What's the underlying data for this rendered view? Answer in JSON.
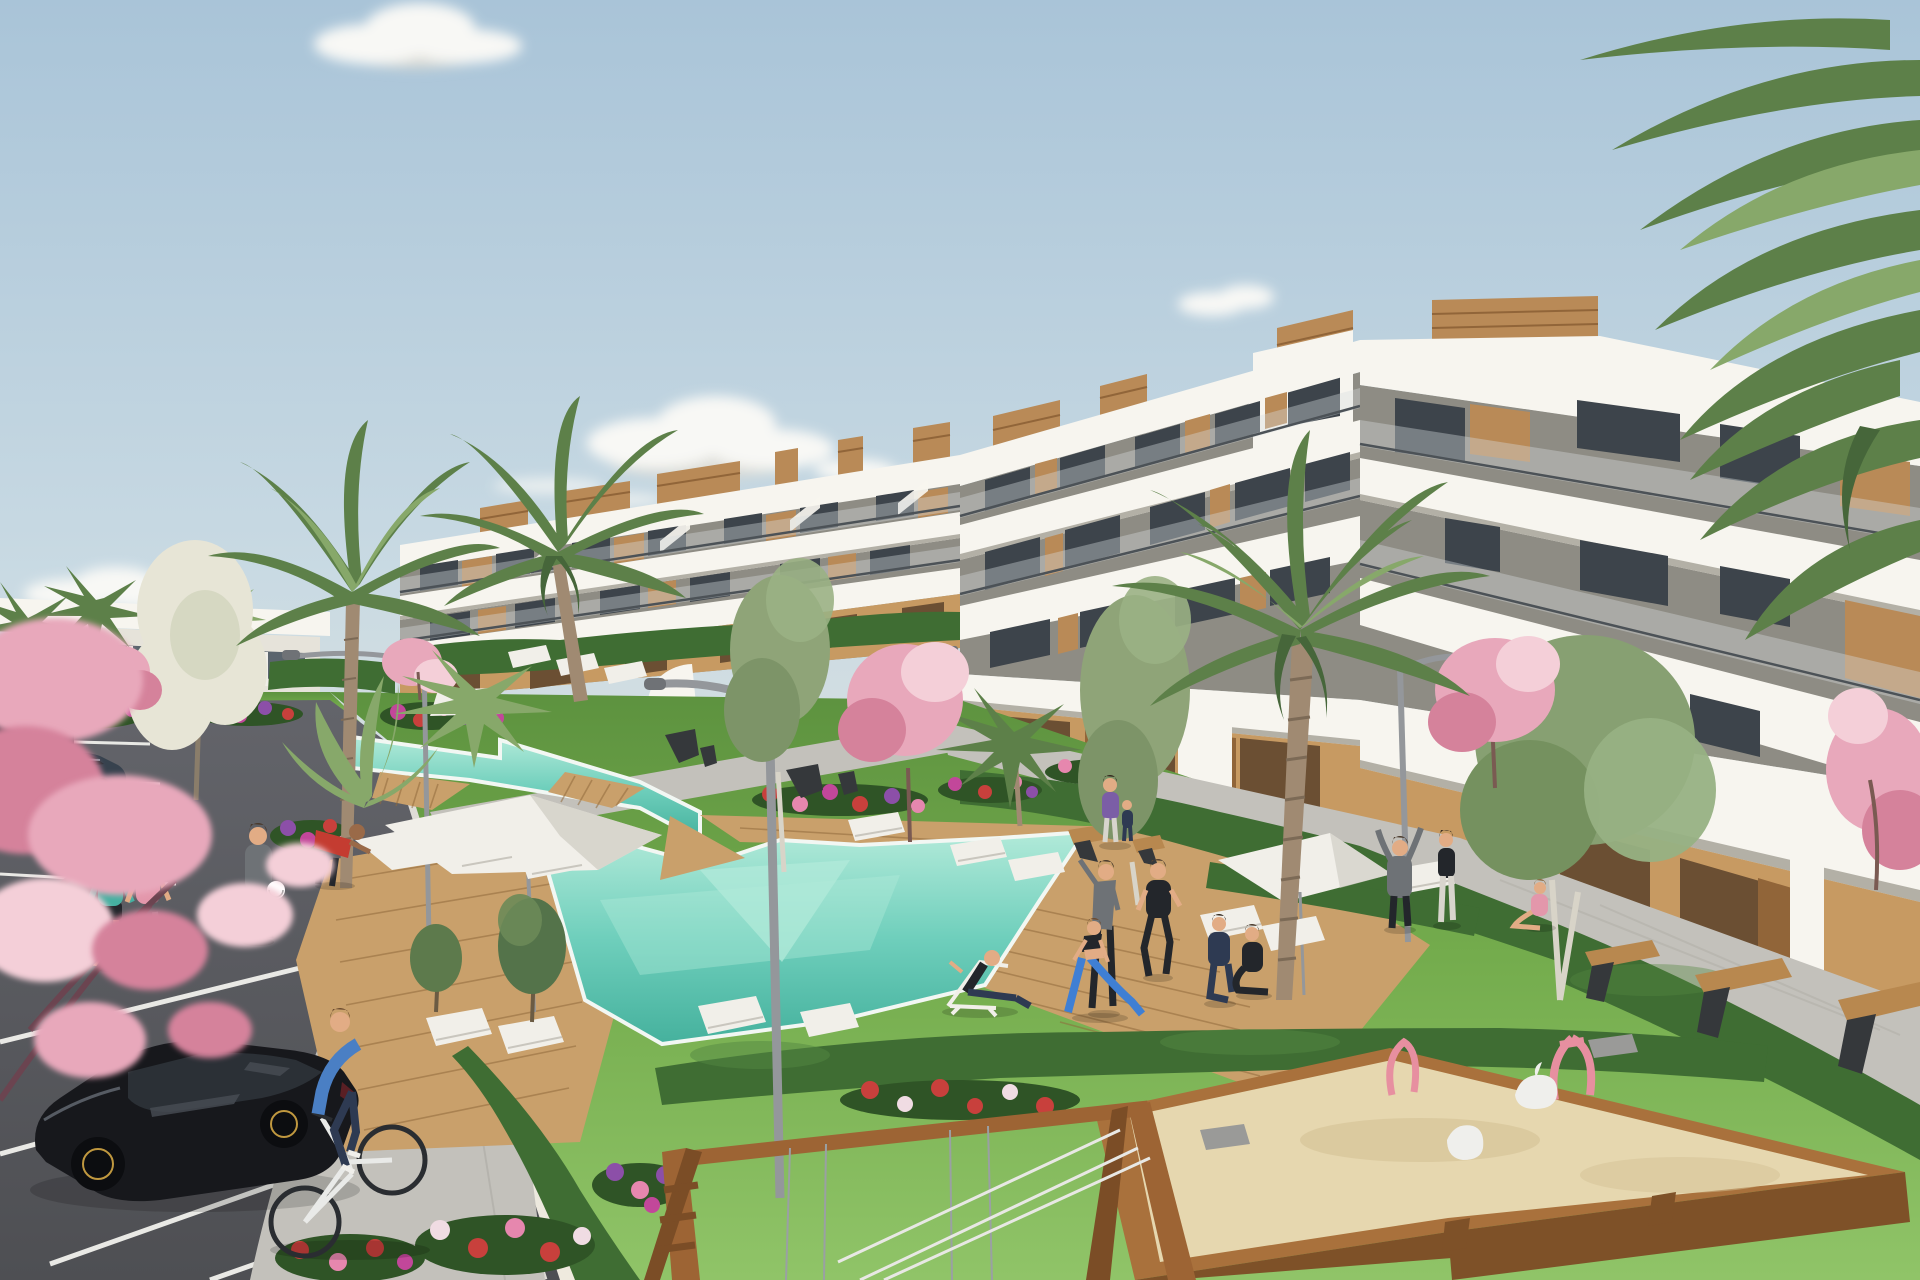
{
  "scene": {
    "type": "architectural-render",
    "description": "Sunny 3D visualisation of a modern white terraced apartment complex with communal gardens, turquoise pools, palm trees, parking lot, playground sandbox and residents relaxing outdoors",
    "time_of_day": "daytime",
    "sky": {
      "clouds": 5,
      "tone": "pale blue with warm haze at horizon"
    }
  },
  "palette": {
    "sky_top": "#a9c4d8",
    "sky_mid": "#c9dae3",
    "sky_low": "#e7e6dd",
    "sky_haze": "#efeade",
    "cloud": "#f8f8f5",
    "cloud_shade": "#dcdcd6",
    "white_sun": "#f7f5ef",
    "white_shade": "#e6e3da",
    "white_dark": "#cbc8bf",
    "fascia_under": "#b3b0a6",
    "recess": "#8e8c84",
    "glass_dark": "#3d444b",
    "glass_mid": "#5a646d",
    "glass_rail": "rgba(215,222,224,0.38)",
    "rail": "#4c5257",
    "wood": "#b98a57",
    "wood_dark": "#916539",
    "wood_light": "#d0a976",
    "tan_wall": "#c79a62",
    "tan_dark": "#a87c49",
    "opening": "#6b4f33",
    "opening_dark": "#46331f",
    "grass_light": "#90c468",
    "grass": "#74ac4d",
    "grass_dark": "#5d923f",
    "hedge": "#3f6d33",
    "hedge_light": "#548741",
    "hedge_dark": "#2f5426",
    "flower_red": "#c8403c",
    "flower_magenta": "#c2479a",
    "flower_purple": "#8c4fa8",
    "flower_pink": "#e687ae",
    "flower_white": "#f0dce3",
    "pool_light": "#b2ead9",
    "pool": "#6fcfbc",
    "pool_deep": "#45b19d",
    "pool_rim": "#f2f7f3",
    "deck": "#c9a06b",
    "deck_dark": "#ab7f49",
    "deck_line": "#8f6a3c",
    "path": "#c3c1bb",
    "path_dark": "#a9a7a1",
    "curb": "#dedcd6",
    "asphalt": "#4e4f53",
    "asphalt_light": "#63646a",
    "line_white": "#e9e9e5",
    "lamp": "#94979b",
    "lamp_dark": "#6f7276",
    "car_black": "#17181c",
    "car_glass": "#2b3036",
    "car_highlight": "#484d55",
    "rim_gold": "#c0983f",
    "sedan": "#37424e",
    "suv": "#2b3137",
    "bench_wood": "#b8884f",
    "bench_dark": "#35383b",
    "sand": "#e6d7af",
    "sand_dark": "#d3c195",
    "box_wood": "#a9713c",
    "box_wood_dark": "#7e5128",
    "toy_pink": "#e78fa0",
    "toy_gray": "#9a9a98",
    "toy_white": "#efefec",
    "swing_wood": "#9d6434",
    "swing_dark": "#7b4d26",
    "cable": "#9aa0a3",
    "rope_white": "#e8e8e4",
    "skin": "#e2ac85",
    "skin_dark": "#9a6a48",
    "palm_green": "#5d8049",
    "palm_light": "#87a86a",
    "palm_dark": "#46663a",
    "palm_trunk": "#a08a72",
    "blossom_pink": "#e8a8bb",
    "blossom_deep": "#d5829b",
    "blossom_light": "#f4cfd8",
    "white_tree": "#e7e5d6",
    "lounger_white": "#f1efe9",
    "cloth_teal": "#45b0a1",
    "cloth_pink": "#e397ab",
    "cloth_blue": "#4a7fc4",
    "cloth_navy": "#2e3a52",
    "cloth_gray": "#6e7276",
    "cloth_red": "#c43c31",
    "cloth_purple": "#7b5ea6",
    "cloth_black": "#23262b",
    "legging_blue": "#3f7fd4",
    "bike_white": "#e9eae8"
  },
  "architecture": {
    "main_building": {
      "style": "stepped white terraced apartment block",
      "floors_visible": 4,
      "features": [
        "white balcony parapet bands",
        "glass balustrades",
        "dark glazing",
        "timber slat accent panels",
        "timber penthouse roof boxes",
        "roof terrace stairs",
        "arched ground-floor piers",
        "ochre ground-floor walls"
      ]
    },
    "distant_building": {
      "style": "low white block with dark glazing",
      "position": "far left"
    }
  },
  "amenities": {
    "pools": [
      {
        "name": "lap pool",
        "shape": "narrow angled channel",
        "position": "upper left"
      },
      {
        "name": "main pool",
        "shape": "angular freeform with shallow wedge",
        "position": "centre"
      }
    ],
    "wooden_decks": 3,
    "white_parasols": 3,
    "white_pergola": 1,
    "sun_loungers_white": 13,
    "designer_chairs_dark": 5,
    "benches_wood": 5,
    "street_lamps": 4
  },
  "vegetation": {
    "palm_trees_large": 3,
    "palm_trees_small": 6,
    "pink_blossom_trees": 6,
    "white_blossom_tree": 1,
    "green_trees": 5,
    "hedges": "clipped dark-green rows along paths and building base",
    "flower_beds": "magenta, red, purple and pink perennials"
  },
  "vehicles": [
    {
      "type": "black hatchback",
      "state": "parked",
      "position": "foreground parking"
    },
    {
      "type": "dark sedan",
      "state": "parked",
      "position": "mid parking"
    },
    {
      "type": "dark SUV",
      "state": "parked",
      "position": "far parking"
    }
  ],
  "people": [
    {
      "role": "cyclist",
      "clothing": "blue sweater, navy trousers",
      "position": "parking lane"
    },
    {
      "role": "jogger",
      "clothing": "teal top",
      "position": "sidewalk"
    },
    {
      "role": "jogger",
      "clothing": "pink top",
      "position": "sidewalk"
    },
    {
      "role": "man with football",
      "clothing": "gray tee",
      "position": "lawn"
    },
    {
      "role": "man tending flowers",
      "clothing": "red shirt",
      "position": "flower bed"
    },
    {
      "role": "man on deck chair",
      "clothing": "dark outfit",
      "position": "poolside lawn"
    },
    {
      "role": "stretching man",
      "clothing": "gray top",
      "position": "exercise lawn"
    },
    {
      "role": "runner",
      "clothing": "black sportswear",
      "position": "exercise lawn"
    },
    {
      "role": "lunging woman",
      "clothing": "black bra, blue leggings",
      "position": "exercise lawn"
    },
    {
      "role": "kneeling man",
      "clothing": "navy tracksuit",
      "position": "exercise lawn"
    },
    {
      "role": "seated woman",
      "clothing": "dark tracksuit",
      "position": "exercise lawn"
    },
    {
      "role": "woman with child",
      "clothing": "purple top",
      "position": "promenade"
    },
    {
      "role": "man arms raised",
      "clothing": "gray hoodie",
      "position": "right path"
    },
    {
      "role": "standing woman",
      "clothing": "black top, white trousers",
      "position": "right path"
    },
    {
      "role": "sitting girl",
      "clothing": "pink top",
      "position": "right path"
    }
  ],
  "playground": {
    "sandbox": {
      "frame": "timber beams",
      "toys": [
        "pink spring rider",
        "pink flamingo rocker",
        "white swan rocker",
        "white rocker",
        "gray digger toy"
      ]
    },
    "swing_frame": "timber A-frame with ladder and cables",
    "rope_fence": "white cords on low posts"
  },
  "parking": {
    "stall_lines": "white painted",
    "surface": "dark asphalt",
    "curb": "light concrete"
  }
}
